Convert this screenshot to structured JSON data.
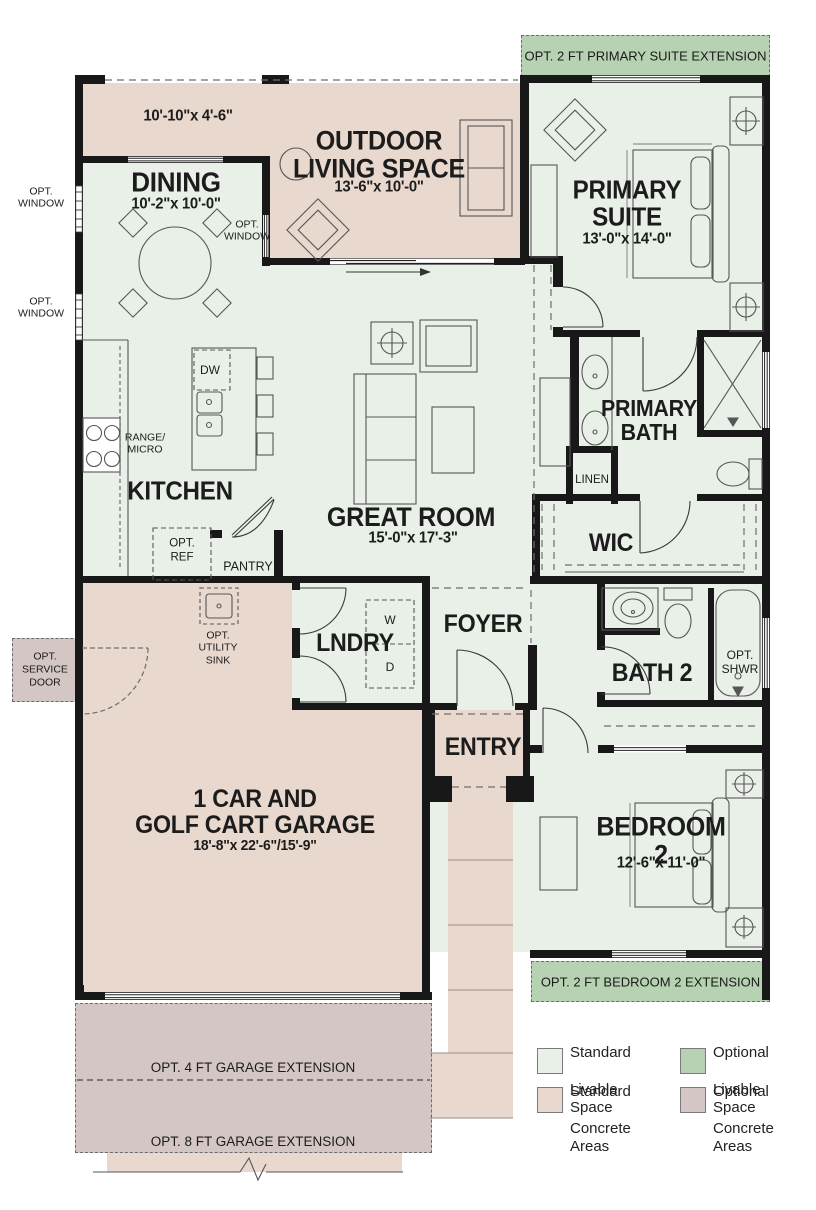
{
  "colors": {
    "standard_livable": "#e9f0e8",
    "optional_livable": "#b7d2b2",
    "standard_concrete": "#e9d8ce",
    "optional_concrete": "#d3c6c4",
    "wall": "#181818"
  },
  "rooms": {
    "patio": {
      "dims": "10'-10\"x 4'-6\""
    },
    "dining": {
      "name": "DINING",
      "dims": "10'-2\"x 10'-0\""
    },
    "outdoor": {
      "name": "OUTDOOR\nLIVING SPACE",
      "dims": "13'-6\"x 10'-0\""
    },
    "primary_suite": {
      "name": "PRIMARY\nSUITE",
      "dims": "13'-0\"x 14'-0\""
    },
    "great_room": {
      "name": "GREAT ROOM",
      "dims": "15'-0\"x 17'-3\""
    },
    "kitchen": {
      "name": "KITCHEN"
    },
    "primary_bath": {
      "name": "PRIMARY\nBATH"
    },
    "wic": {
      "name": "WIC"
    },
    "linen": {
      "name": "LINEN"
    },
    "laundry": {
      "name": "LNDRY"
    },
    "foyer": {
      "name": "FOYER"
    },
    "entry": {
      "name": "ENTRY"
    },
    "bath2": {
      "name": "BATH 2"
    },
    "bedroom2": {
      "name": "BEDROOM 2",
      "dims": "12'-6\"x 11'-0\""
    },
    "garage": {
      "name": "1 CAR AND\nGOLF CART GARAGE",
      "dims": "18'-8\"x 22'-6\"/15'-9\""
    }
  },
  "annotations": {
    "opt_window": "OPT.\nWINDOW",
    "opt_service_door": "OPT.\nSERVICE\nDOOR",
    "range_micro": "RANGE/\nMICRO",
    "dw": "DW",
    "opt_ref": "OPT.\nREF",
    "pantry": "PANTRY",
    "opt_utility_sink": "OPT.\nUTILITY\nSINK",
    "washer": "W",
    "dryer": "D",
    "opt_shwr": "OPT.\nSHWR"
  },
  "banners": {
    "primary_suite_extension": "OPT. 2 FT PRIMARY SUITE EXTENSION",
    "bedroom2_extension": "OPT. 2 FT BEDROOM 2 EXTENSION",
    "garage_extension_4": "OPT. 4 FT GARAGE EXTENSION",
    "garage_extension_8": "OPT. 8 FT GARAGE EXTENSION"
  },
  "legend": {
    "items": [
      {
        "line1": "Standard",
        "line2": "Livable Space",
        "color": "#e9f0e8"
      },
      {
        "line1": "Optional",
        "line2": "Livable Space",
        "color": "#b7d2b2"
      },
      {
        "line1": "Standard",
        "line2": "Concrete Areas",
        "color": "#e9d8ce"
      },
      {
        "line1": "Optional",
        "line2": "Concrete Areas",
        "color": "#d3c6c4"
      }
    ]
  }
}
